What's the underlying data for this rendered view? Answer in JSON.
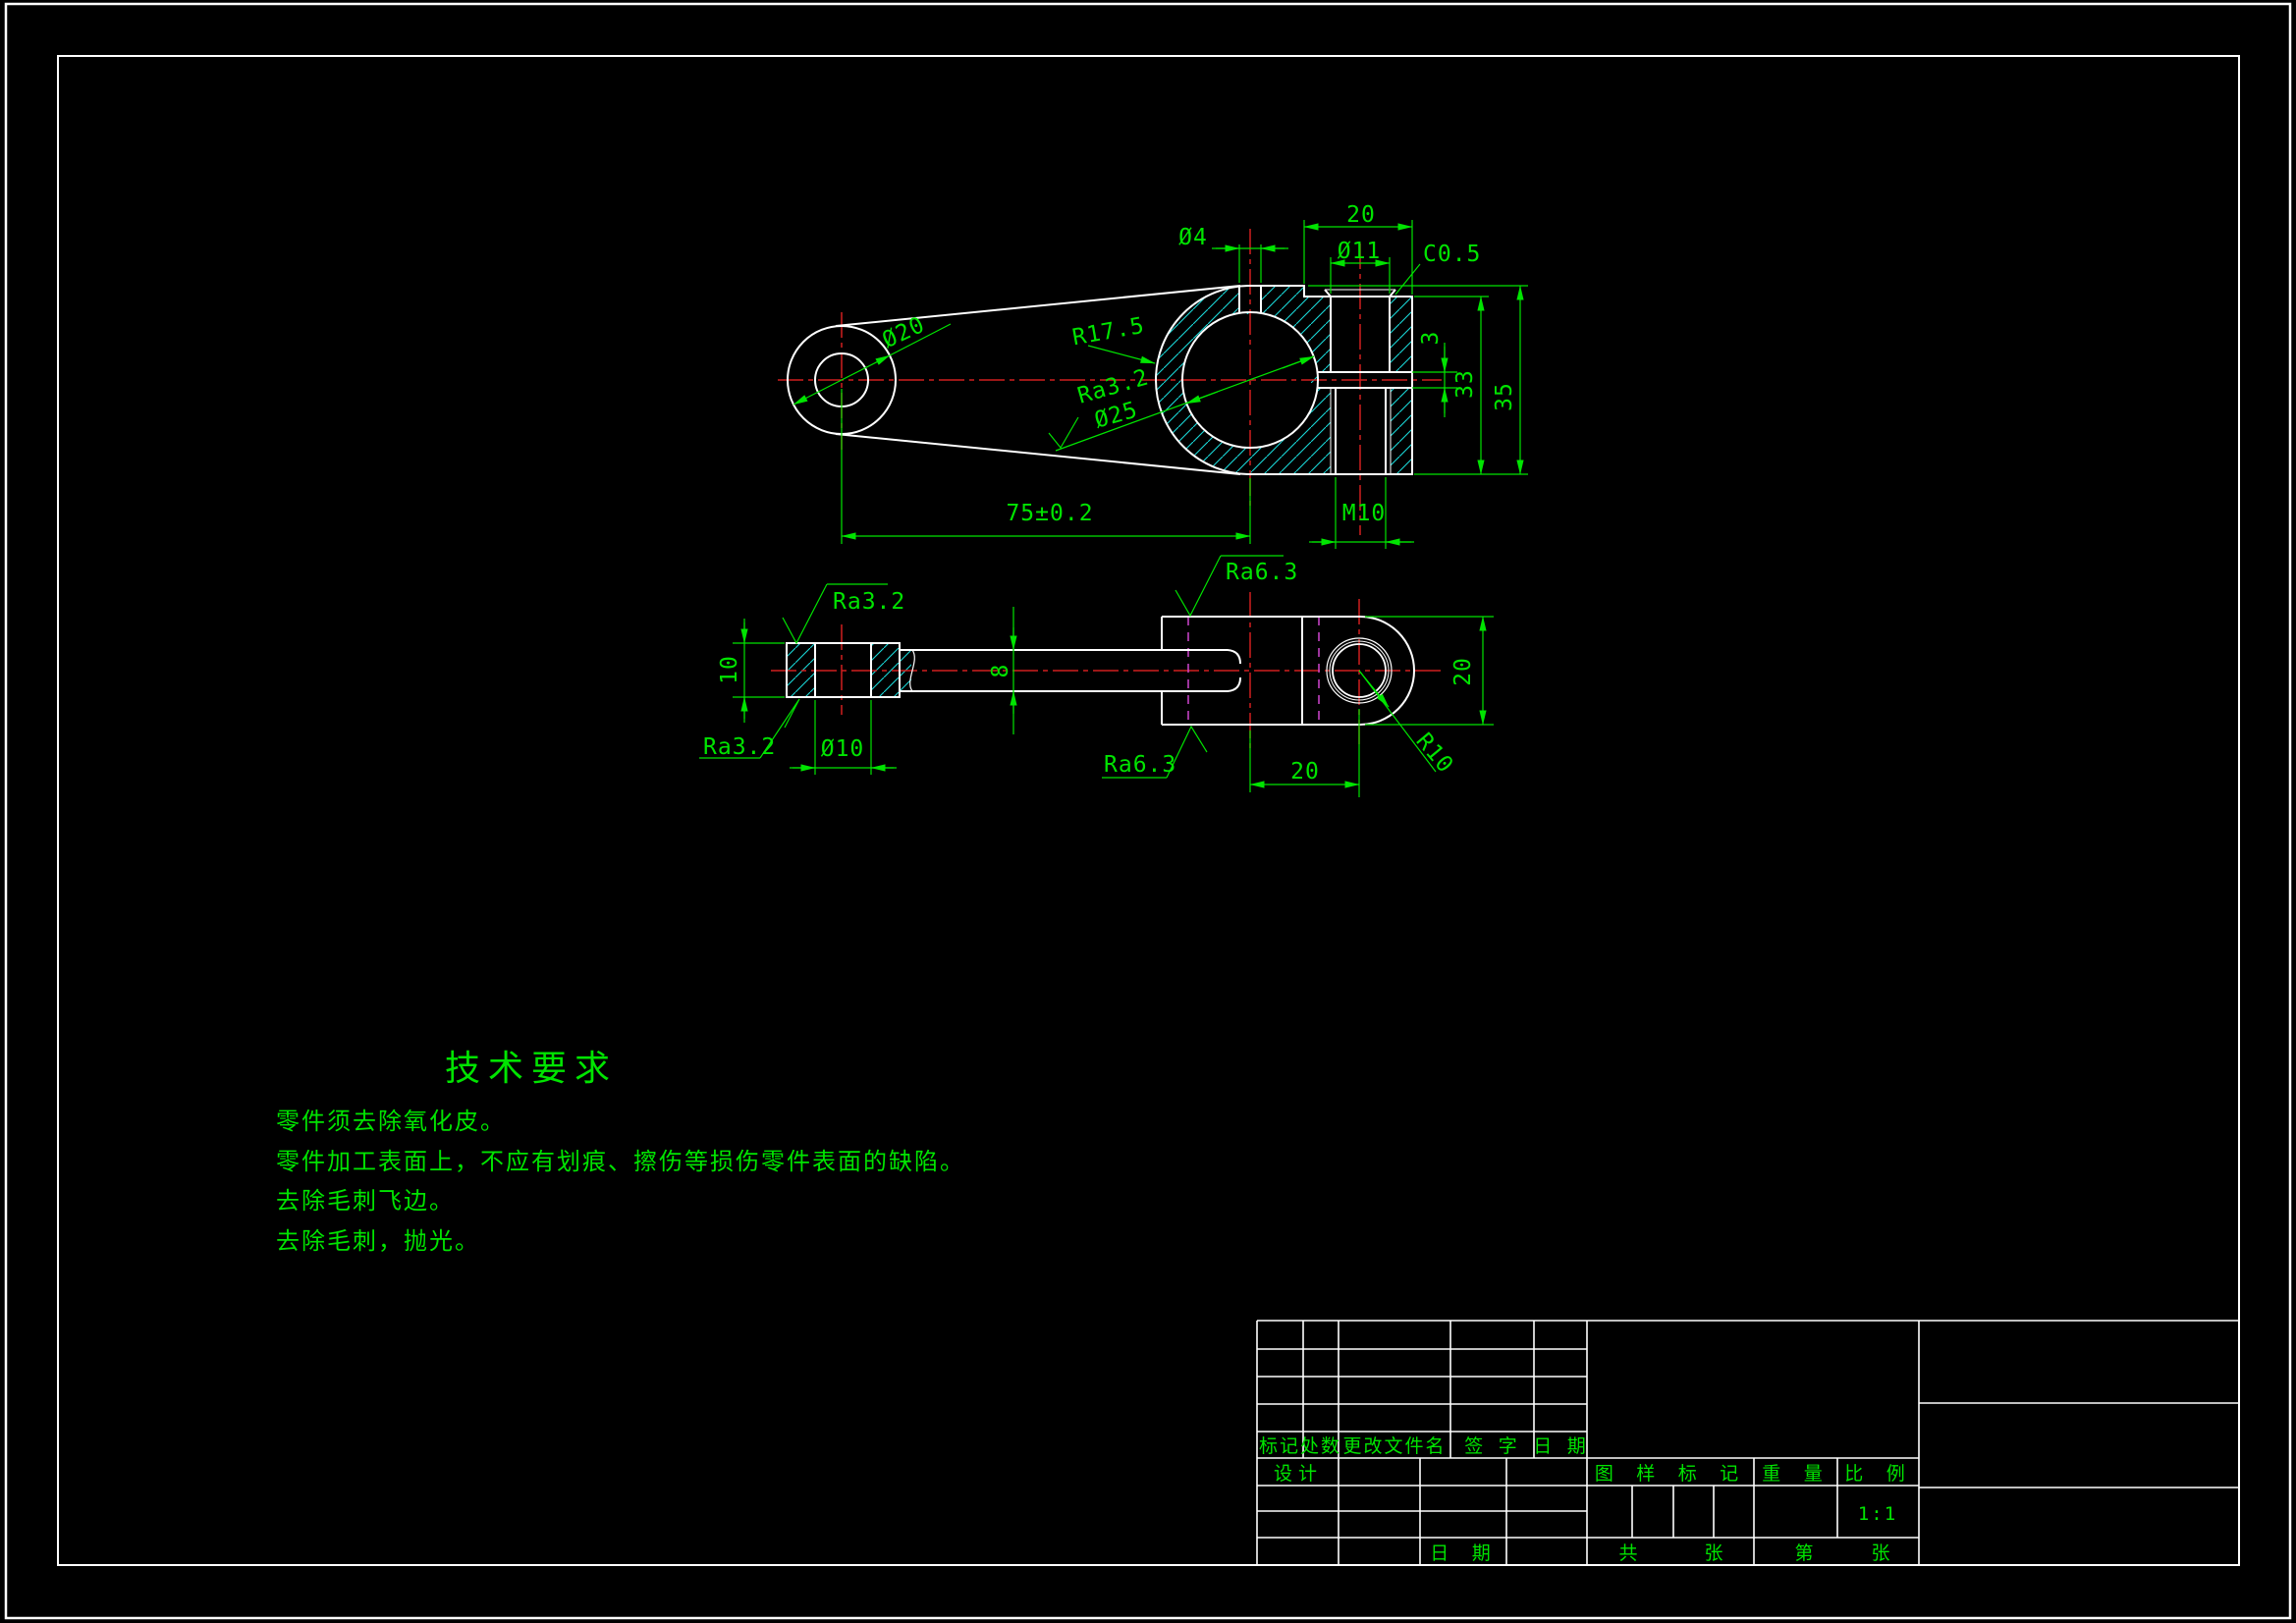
{
  "colors": {
    "background": "#000000",
    "outline": "#ffffff",
    "dimension_green": "#00e400",
    "centerline_red": "#cf1f1f",
    "hatch_cyan": "#19d8d8",
    "datum_magenta": "#cf46cf"
  },
  "top_view": {
    "dims": {
      "boss_dia": "Ø20",
      "pin_hole_dia": "Ø4",
      "ear_width": "20",
      "counterbore_dia": "Ø11",
      "chamfer": "C0.5",
      "outer_radius": "R17.5",
      "bore_roughness": "Ra3.2",
      "bore_dia": "Ø25",
      "slit_height": "3",
      "inner_height": "33",
      "clamp_height": "35",
      "thread": "M10",
      "center_distance": "75±0.2"
    }
  },
  "front_view": {
    "dims": {
      "hub_height": "10",
      "hub_hole_dia": "Ø10",
      "hub_roughness_top": "Ra3.2",
      "hub_roughness_bottom": "Ra3.2",
      "shaft_height": "8",
      "fork_roughness_top": "Ra6.3",
      "fork_roughness_bottom": "Ra6.3",
      "eye_height": "20",
      "eye_offset": "20",
      "eye_radius": "R10"
    }
  },
  "technical_requirements": {
    "title": "技术要求",
    "items": [
      "零件须去除氧化皮。",
      "零件加工表面上，不应有划痕、擦伤等损伤零件表面的缺陷。",
      "去除毛刺飞边。",
      "去除毛刺，抛光。"
    ]
  },
  "title_block": {
    "rev_mark": "标记",
    "rev_count": "处数",
    "rev_file": "更改文件名",
    "rev_sign": "签 字",
    "rev_date": "日 期",
    "design_label": "设计",
    "date_label": "日 期",
    "stamp_header": "图 样 标 记",
    "weight_header": "重 量",
    "scale_header": "比 例",
    "scale_value": "1:1",
    "total_prefix": "共",
    "total_suffix": "张",
    "page_prefix": "第",
    "page_suffix": "张"
  }
}
